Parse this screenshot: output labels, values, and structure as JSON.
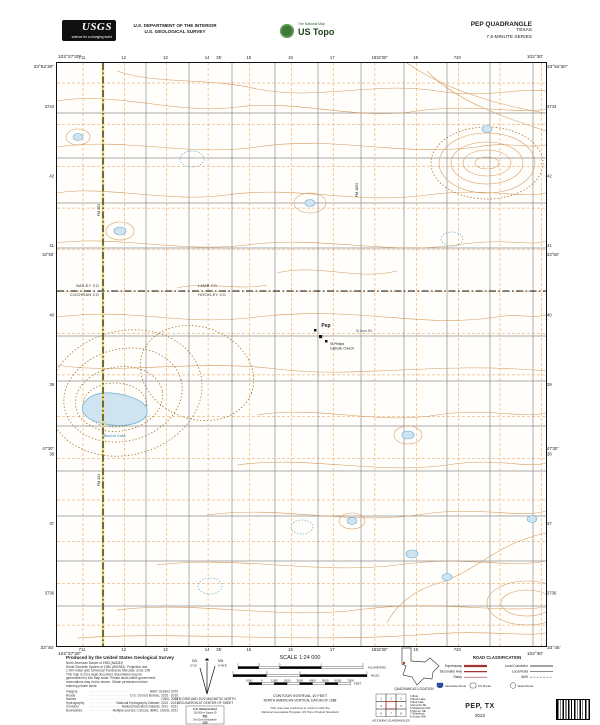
{
  "header": {
    "usgs_brand": "USGS",
    "usgs_tagline": "science for a changing world",
    "dept_line1": "U.S. DEPARTMENT OF THE INTERIOR",
    "dept_line2": "U.S. GEOLOGICAL SURVEY",
    "ustopo_tagline": "The National Map",
    "ustopo_brand": "US Topo",
    "quad_line1": "PEP QUADRANGLE",
    "quad_line2": "TEXAS",
    "quad_line3": "7.5-MINUTE SERIES"
  },
  "map": {
    "corners": {
      "tl_lon": "102°37'30\"",
      "tl_lat": "33°52'30\"",
      "tr_lon": "102°30'",
      "tr_lat": "33°52'30\"",
      "bl_lat": "33°45'",
      "bl_lon": "102°37'30\"",
      "br_lon": "102°30'",
      "br_lat": "33°45'"
    },
    "ticks_top": [
      "711",
      "12",
      "13",
      "14",
      "15",
      "16",
      "17",
      "18",
      "19",
      "720"
    ],
    "ticks_bottom": [
      "711",
      "12",
      "13",
      "14",
      "15",
      "16",
      "17",
      "18",
      "19",
      "720"
    ],
    "ticks_left": [
      "3743",
      "42",
      "41",
      "40",
      "39",
      "38",
      "37",
      "3736"
    ],
    "ticks_right": [
      "3743",
      "42",
      "41",
      "40",
      "39",
      "38",
      "37",
      "3736"
    ],
    "mid_top": [
      "35'",
      "32'30\""
    ],
    "mid_bottom": [
      "35'",
      "32'30\""
    ],
    "mid_left": [
      "33°50'",
      "47'30\""
    ],
    "mid_right": [
      "33°50'",
      "47'30\""
    ],
    "counties": {
      "nw": "BAILEY CO",
      "sw": "COCHRAN CO",
      "ne": "LAMB CO",
      "se": "HOCKLEY CO"
    },
    "labels": {
      "town": "Pep",
      "church1": "St Philips",
      "church2": "Catholic Church",
      "street": "St Anns Rd",
      "lake": "Illusion Lake",
      "road_v": "FM 303",
      "road_v2": "FM 1894"
    },
    "colors": {
      "contour": "#d49a5d",
      "depression": "#a5702c",
      "water_fill": "#cfe3f0",
      "water_line": "#6aadd2",
      "utm_grid": "#e59849",
      "road": "#8c8c8c",
      "boundary": "#111111"
    }
  },
  "footer": {
    "credit_title": "Produced by the United States Geological Survey",
    "credit_lines": [
      "North American Datum of 1983 (NAD83)",
      "World Geodetic System of 1984 (WGS84).  Projection and",
      "1 000-meter grid: Universal Transverse Mercator, Zone 13R",
      "This map is not a legal document. Boundaries may be",
      "generalized for this map scale. Private lands within government",
      "reservations may not be shown. Obtain permission before",
      "entering private lands."
    ],
    "sources": [
      [
        "Imagery",
        "NAIP, October 2020"
      ],
      [
        "Roads",
        "U.S. Census Bureau, 2015 - 2019"
      ],
      [
        "Names",
        "GNIS, 2021"
      ],
      [
        "Hydrography",
        "National Hydrography Dataset, 2013 - 2021"
      ],
      [
        "Contours",
        "National Elevation Dataset, 2011 - 2021"
      ],
      [
        "Boundaries",
        "Multiple sources; Census, IBWC, USGS, 2021"
      ]
    ],
    "declination": {
      "caption1": "UTM GRID AND 2022 MAGNETIC NORTH",
      "caption2": "DECLINATION AT CENTER OF SHEET",
      "gn": "GN",
      "gn_value": "0°16'",
      "mn": "MN",
      "mn_value": "6°46'E"
    },
    "usng": {
      "title": "U.S. National Grid",
      "sq_label": "100,000-m Square ID",
      "square": "PU",
      "zone_label": "Grid Zone Designation",
      "zone": "13S"
    },
    "scale": {
      "title": "SCALE 1:24 000",
      "km_labels": [
        "1",
        ".5",
        "0",
        "1",
        "2"
      ],
      "km_unit": "KILOMETERS",
      "mi_labels": [
        "1",
        ".5",
        "0",
        "1"
      ],
      "mi_unit": "MILES",
      "ft_labels": [
        "1000",
        "0",
        "1000",
        "2000",
        "3000",
        "4000",
        "5000",
        "6000",
        "7000"
      ],
      "ft_unit": "FEET"
    },
    "contour_note1": "CONTOUR INTERVAL 10 FEET",
    "contour_note2": "NORTH AMERICAN VERTICAL DATUM OF 1988",
    "standard_note1": "This map was produced to conform with the",
    "standard_note2": "National Geospatial Program US Topo Product Standard",
    "inset_caption": "QUADRANGLE LOCATION",
    "adjoining": {
      "caption": "ADJOINING QUADRANGLES",
      "grid_numbers": [
        "1",
        "2",
        "3",
        "4",
        "5",
        "6",
        "7",
        "8"
      ],
      "names": [
        "1  Bula",
        "2  Beck Lake",
        "3  Bull Lake",
        "4  Enochs SE",
        "5  Whiteface NW",
        "6  Morton NE",
        "7  Whiteface",
        "8  Smyer NW"
      ]
    },
    "road_class": {
      "title": "ROAD CLASSIFICATION",
      "left": [
        "Expressway",
        "Secondary Hwy",
        "Ramp"
      ],
      "right": [
        "Local Connector",
        "Local Road",
        "4WD"
      ],
      "shields": [
        "Interstate Route",
        "US Route",
        "State Route"
      ]
    },
    "title": "PEP, TX",
    "year": "2022"
  }
}
